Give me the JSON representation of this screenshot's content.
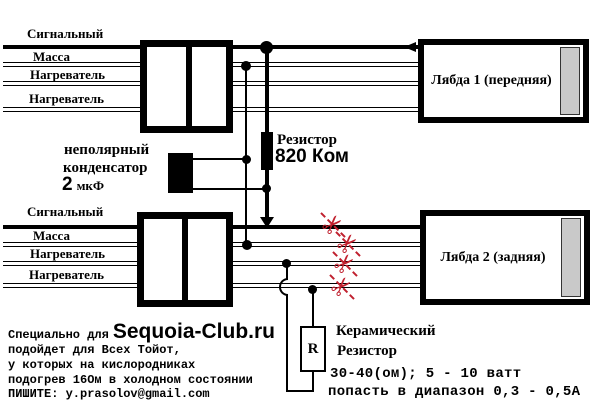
{
  "diagram": {
    "wire_labels": [
      "Сигнальный",
      "Масса",
      "Нагреватель",
      "Нагреватель"
    ],
    "lambda1_label": "Лябда 1 (передняя)",
    "lambda2_label": "Лябда 2 (задняя)",
    "resistor": {
      "label": "Резистор",
      "value": "820 Ком"
    },
    "capacitor": {
      "label_line1": "неполярный",
      "label_line2": "конденсатор",
      "value": "2",
      "unit": "мкФ"
    },
    "ceramic_resistor": {
      "symbol": "R",
      "line1": "Керамический",
      "line2": "Резистор",
      "line3": "30-40(ом); 5 - 10 ватт",
      "line4": "попасть в диапазон 0,3 - 0,5А"
    },
    "cut_icon": "✂"
  },
  "footer": {
    "prefix": "Специально для",
    "site": "Sequoia-Club.ru",
    "line2": "подойдет для Всех Тойот,",
    "line3": "у которых на кислородниках",
    "line4": "подогрев 16Ом в холодном состоянии",
    "line5": "ПИШИТЕ: y.prasolov@gmail.com"
  },
  "colors": {
    "wire": "#000000",
    "cut_mark": "#c0202e",
    "connector_strip": "#c9c9c9",
    "background": "#ffffff"
  }
}
